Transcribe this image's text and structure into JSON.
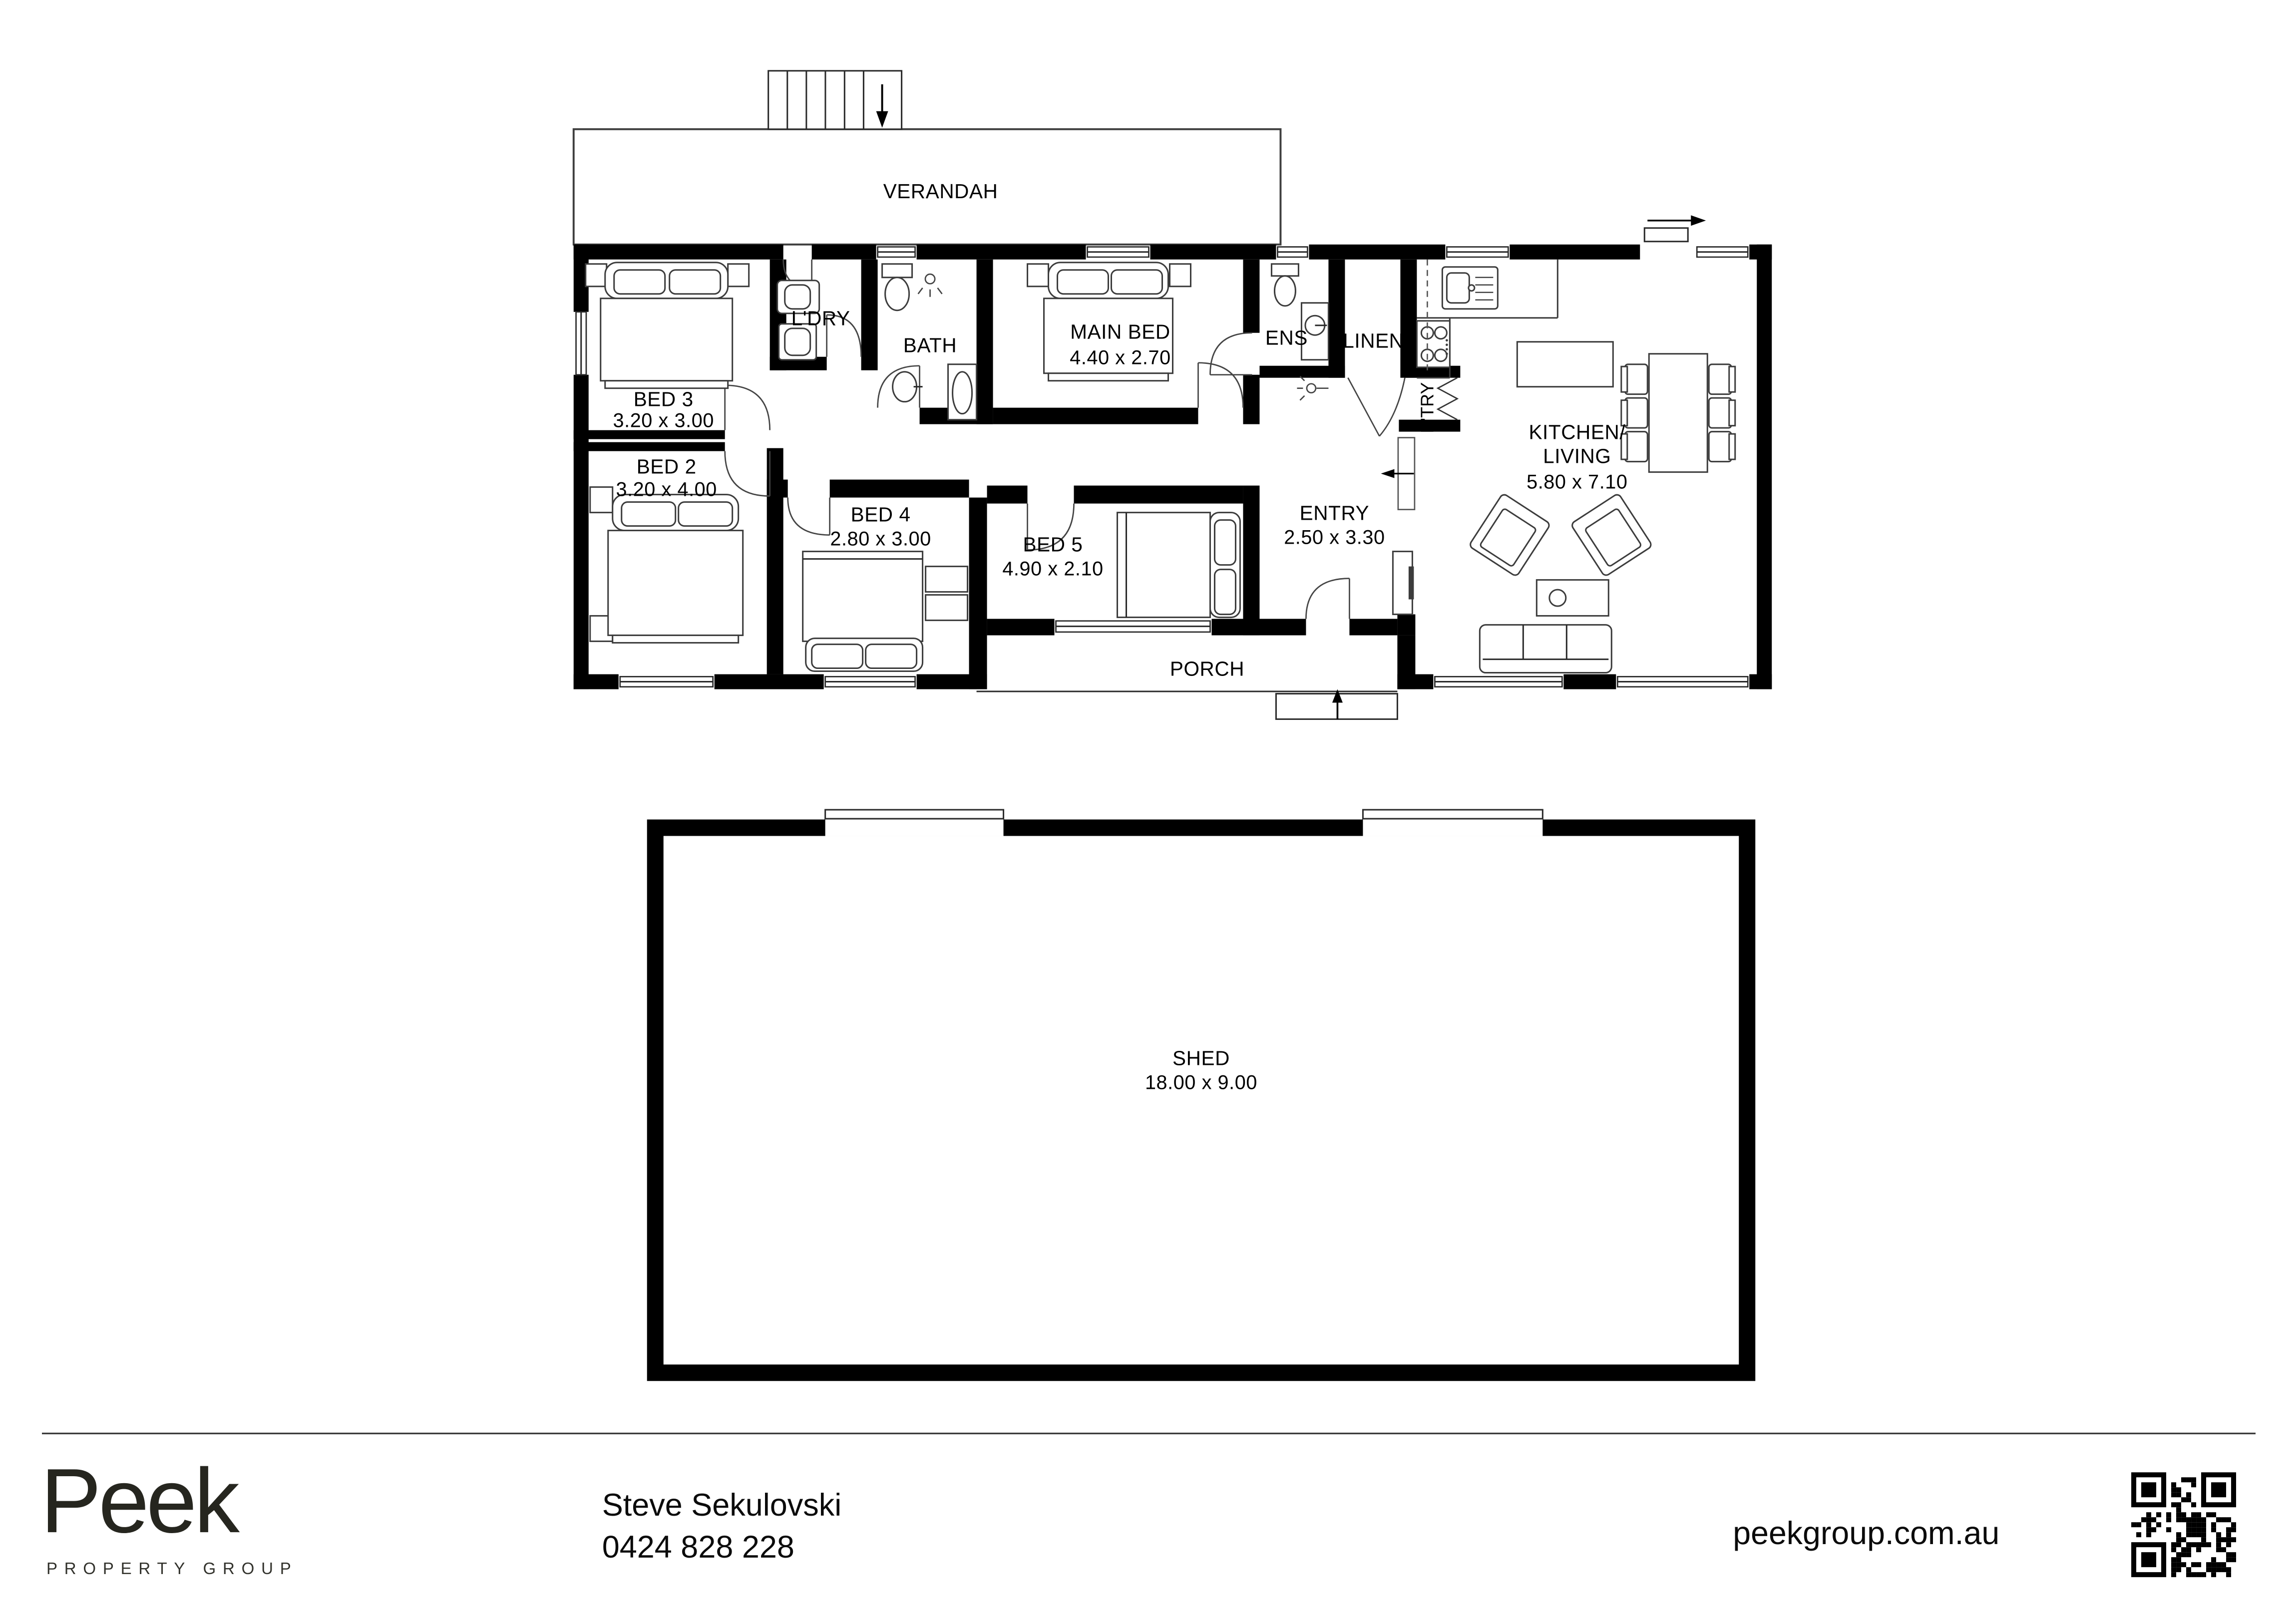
{
  "plan": {
    "rooms": {
      "verandah": {
        "label": "VERANDAH"
      },
      "bed3": {
        "label": "BED 3",
        "dims": "3.20 x 3.00"
      },
      "bed2": {
        "label": "BED 2",
        "dims": "3.20 x 4.00"
      },
      "ldry": {
        "label": "L'DRY"
      },
      "bath": {
        "label": "BATH"
      },
      "main_bed": {
        "label": "MAIN BED",
        "dims": "4.40 x 2.70"
      },
      "ens": {
        "label": "ENS"
      },
      "linen": {
        "label": "LINEN"
      },
      "ptry": {
        "label": "P'TRY"
      },
      "kitchen_living": {
        "line1": "KITCHEN/",
        "line2": "LIVING",
        "dims": "5.80 x 7.10"
      },
      "bed4": {
        "label": "BED 4",
        "dims": "2.80 x 3.00"
      },
      "bed5": {
        "label": "BED 5",
        "dims": "4.90 x 2.10"
      },
      "entry": {
        "label": "ENTRY",
        "dims": "2.50 x 3.30"
      },
      "porch": {
        "label": "PORCH"
      },
      "shed": {
        "label": "SHED",
        "dims": "18.00 x 9.00"
      }
    }
  },
  "footer": {
    "brand": "Peek",
    "brand_tagline": "PROPERTY GROUP",
    "agent_name": "Steve Sekulovski",
    "agent_phone": "0424 828 228",
    "website": "peekgroup.com.au"
  },
  "colors": {
    "wall": "#000000",
    "line": "#2a2a2a",
    "text": "#000000",
    "background": "#ffffff"
  }
}
